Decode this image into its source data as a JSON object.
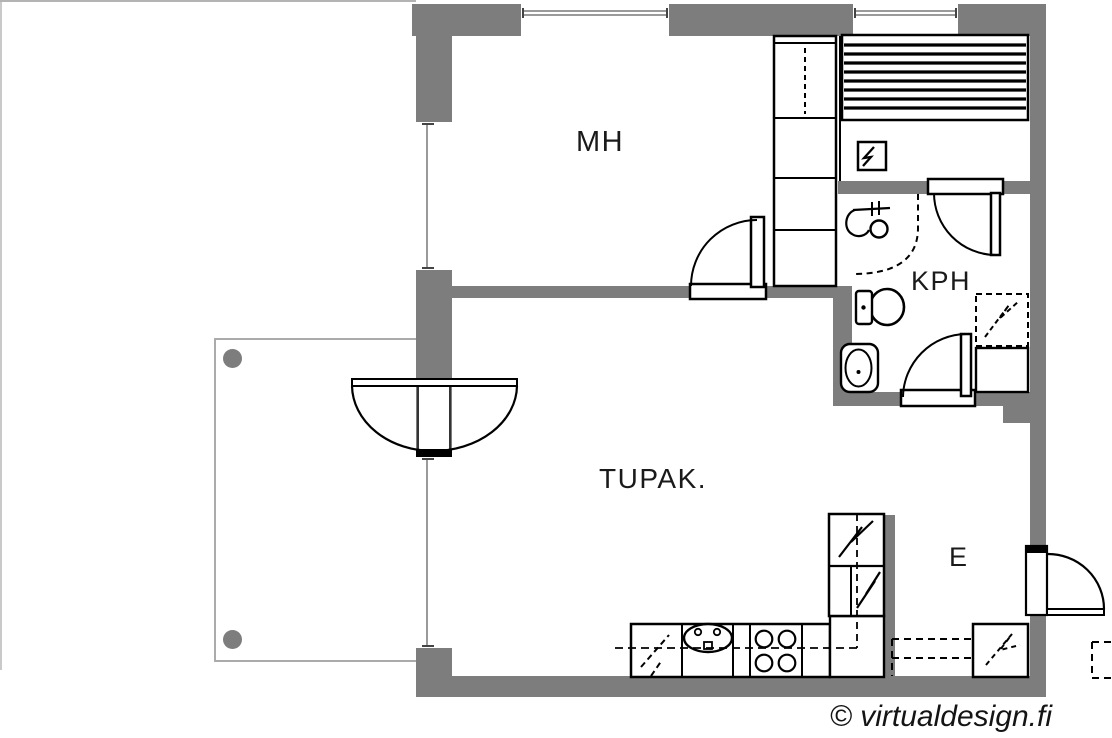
{
  "plan": {
    "rooms": [
      {
        "label": "MH"
      },
      {
        "label": "KPH"
      },
      {
        "label": "TUPAK."
      },
      {
        "label": "E"
      }
    ],
    "watermark": "© virtualdesign.fi",
    "colors": {
      "wall": "#7d7d7d",
      "linework": "#000000",
      "thin_line": "#b3b3b3",
      "post": "#7d7d7d",
      "background": "#ffffff",
      "label_text": "#1a1a1a"
    },
    "icons": [
      "wardrobe-cabinet",
      "shelf-unit",
      "electrical-panel-icon",
      "toilet-icon",
      "bathroom-sink-icon",
      "shower-mixer-icon",
      "shower-area-boundary",
      "washing-machine-reservation",
      "bathroom-cabinet",
      "kitchen-counter",
      "dishwasher-reservation",
      "kitchen-sink-icon",
      "stove-icon",
      "fridge-freezer-cabinet",
      "entry-cabinet-reservation",
      "worktop-reservation",
      "balcony",
      "balcony-post",
      "door-swing"
    ]
  }
}
